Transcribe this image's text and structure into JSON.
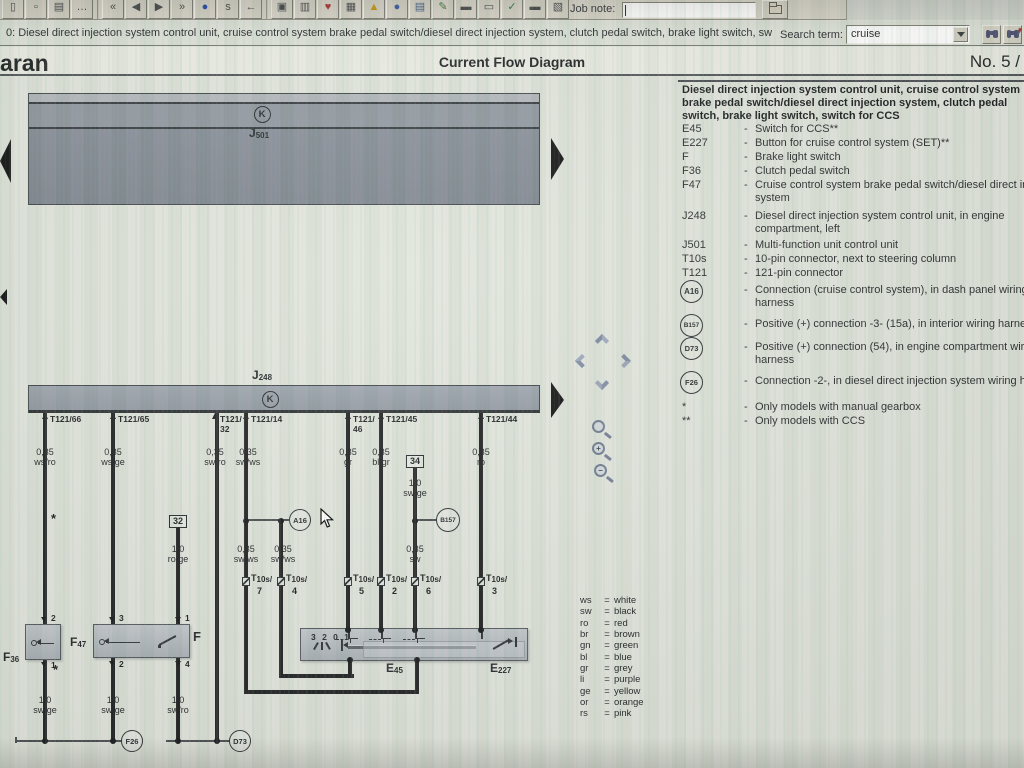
{
  "toolbar": {
    "job_note_label": "Job note:",
    "buttons": [
      {
        "name": "new-document",
        "glyph": "▯"
      },
      {
        "name": "open-document",
        "glyph": "▫"
      },
      {
        "name": "print",
        "glyph": "▤"
      },
      {
        "name": "more-options",
        "glyph": "…"
      },
      {
        "name": "nav-first",
        "glyph": "«"
      },
      {
        "name": "nav-previous",
        "glyph": "◀"
      },
      {
        "name": "nav-next",
        "glyph": "▶"
      },
      {
        "name": "nav-last",
        "glyph": "»"
      },
      {
        "name": "info",
        "glyph": "●"
      },
      {
        "name": "history",
        "glyph": "s"
      },
      {
        "name": "back",
        "glyph": "←"
      },
      {
        "name": "save",
        "glyph": "▣"
      },
      {
        "name": "print-preview",
        "glyph": "▥"
      },
      {
        "name": "favorites",
        "glyph": "♥"
      },
      {
        "name": "notes",
        "glyph": "▦"
      },
      {
        "name": "warning",
        "glyph": "▲"
      },
      {
        "name": "online",
        "glyph": "●"
      },
      {
        "name": "print-document",
        "glyph": "▤"
      },
      {
        "name": "edit",
        "glyph": "✎"
      },
      {
        "name": "vehicle-data",
        "glyph": "▬"
      },
      {
        "name": "vehicle-search",
        "glyph": "▭"
      },
      {
        "name": "checklist",
        "glyph": "✓"
      },
      {
        "name": "vehicle-history",
        "glyph": "▬"
      },
      {
        "name": "job-form",
        "glyph": "▧"
      }
    ]
  },
  "nav_bar": {
    "path_text": "0: Diesel direct injection system control unit, cruise control system brake pedal switch/diesel direct injection system, clutch pedal switch, brake light switch, switch",
    "search_label": "Search term:",
    "search_value": "cruise"
  },
  "header": {
    "vehicle": "haran",
    "title": "Current Flow Diagram",
    "page_no": "No. 5 /"
  },
  "right_panel": {
    "dash": "-",
    "title_lines": [
      "Diesel direct injection system control unit, cruise control system",
      "brake pedal switch/diesel direct injection system, clutch pedal",
      "switch, brake light switch, switch for CCS"
    ],
    "entries": [
      {
        "label": "E45",
        "text": "Switch for CCS**"
      },
      {
        "label": "E227",
        "text": "Button for cruise control system (SET)**"
      },
      {
        "label": "F",
        "text": "Brake light switch"
      },
      {
        "label": "F36",
        "text": "Clutch pedal switch"
      },
      {
        "label": "F47",
        "text": "Cruise control system brake pedal switch/diesel direct inj.",
        "text2": "system"
      },
      {
        "label": "J248",
        "text": "Diesel direct injection system control unit, in engine",
        "text2": "compartment, left"
      },
      {
        "label": "J501",
        "text": "Multi-function unit control unit"
      },
      {
        "label": "T10s",
        "text": "10-pin connector, next to steering column"
      },
      {
        "label": "T121",
        "text": "121-pin connector"
      },
      {
        "label": "A16",
        "text": "Connection (cruise control system), in dash panel wiring",
        "text2": "harness"
      },
      {
        "label": "B157",
        "text": "Positive (+) connection -3- (15a), in interior wiring harness"
      },
      {
        "label": "D73",
        "text": "Positive (+) connection (54), in engine compartment wiring",
        "text2": "harness"
      },
      {
        "label": "F26",
        "text": "Connection -2-, in diesel direct injection system wiring harness"
      },
      {
        "label": "*",
        "text": "Only models with manual gearbox"
      },
      {
        "label": "**",
        "text": "Only models with CCS"
      }
    ]
  },
  "diagram": {
    "j501": {
      "p": "J",
      "n": "501",
      "symbol": "K"
    },
    "j248": {
      "p": "J",
      "n": "248",
      "symbol": "K"
    },
    "t121_pins": [
      {
        "l1": "T121/66"
      },
      {
        "l1": "T121/65"
      },
      {
        "l1": "T121/",
        "l2": "32"
      },
      {
        "l1": "T121/14"
      },
      {
        "l1": "T121/",
        "l2": "46"
      },
      {
        "l1": "T121/45"
      },
      {
        "l1": "T121/44"
      }
    ],
    "wire_labels": [
      {
        "size": "0,35",
        "color": "ws/ro"
      },
      {
        "size": "0,35",
        "color": "ws/ge"
      },
      {
        "size": "0,35",
        "color": "sw/ro"
      },
      {
        "size": "0,35",
        "color": "sw/ws"
      },
      {
        "size": "0,35",
        "color": "gr"
      },
      {
        "size": "0,35",
        "color": "bl/gr"
      },
      {
        "size": "0,35",
        "color": "ro"
      }
    ],
    "ref_32": "32",
    "ref_34": "34",
    "mid_labels": {
      "b32": {
        "size": "1,0",
        "color": "ro/ge"
      },
      "a16_left": {
        "size": "0,35",
        "color": "sw/ws"
      },
      "a16_right": {
        "size": "0,35",
        "color": "sw/ws"
      },
      "b34": {
        "size": "1,0",
        "color": "sw/ge"
      },
      "b157": {
        "size": "0,35",
        "color": "sw"
      }
    },
    "asterisk": "*",
    "circles": {
      "a16": "A16",
      "b157": "B157",
      "f26": "F26",
      "d73": "D73"
    },
    "t10s": {
      "p": "T",
      "s": "10s/",
      "numbers": [
        "7",
        "4",
        "5",
        "2",
        "6",
        "3"
      ]
    },
    "components": {
      "f36": {
        "p": "F",
        "n": "36"
      },
      "f47": {
        "p": "F",
        "n": "47"
      },
      "f": {
        "p": "F"
      },
      "e45": {
        "p": "E",
        "n": "45"
      },
      "e227": {
        "p": "E",
        "n": "227"
      },
      "switch_positions": "3 2 0 1"
    },
    "pin_numbers": {
      "f36_top": "2",
      "f36_bottom": "1",
      "f47_top": "3",
      "f47_bottom": "2",
      "f_top": "1",
      "f_bottom": "4"
    },
    "bottom_labels": [
      {
        "size": "1,0",
        "color": "sw/ge"
      },
      {
        "size": "1,0",
        "color": "sw/ge"
      },
      {
        "size": "1,0",
        "color": "sw/ro"
      }
    ]
  },
  "zoom_tools": {
    "in_sign": "+",
    "out_sign": "−"
  },
  "color_legend": {
    "eq": "=",
    "items": [
      {
        "code": "ws",
        "name": "white"
      },
      {
        "code": "sw",
        "name": "black"
      },
      {
        "code": "ro",
        "name": "red"
      },
      {
        "code": "br",
        "name": "brown"
      },
      {
        "code": "gn",
        "name": "green"
      },
      {
        "code": "bl",
        "name": "blue"
      },
      {
        "code": "gr",
        "name": "grey"
      },
      {
        "code": "li",
        "name": "purple"
      },
      {
        "code": "ge",
        "name": "yellow"
      },
      {
        "code": "or",
        "name": "orange"
      },
      {
        "code": "rs",
        "name": "pink"
      }
    ]
  },
  "colors": {
    "wire": "#191a1c",
    "unit_box": "#848b96",
    "component_box": "#b4bac0",
    "toolbar": "#d8d4c8",
    "header_bg": "#e9ebe2"
  }
}
